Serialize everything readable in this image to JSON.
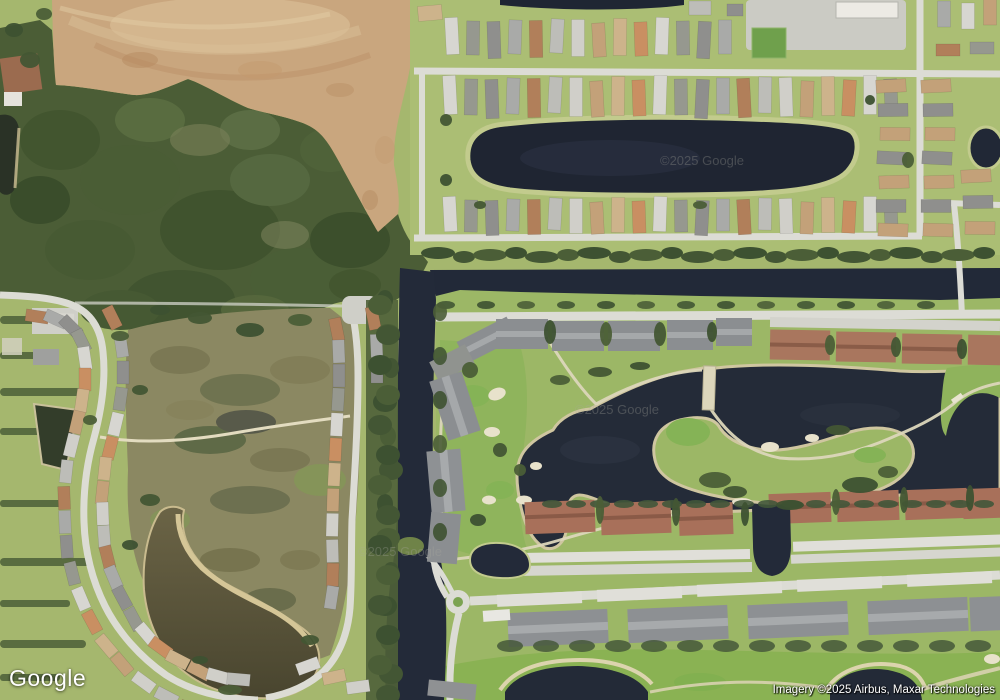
{
  "map": {
    "view_type": "satellite",
    "provider_logo": "Google",
    "attribution": "Imagery ©2025 Airbus, Maxar Technologies",
    "watermark": "©2025 Google"
  },
  "colors": {
    "grass": "#a5b76e",
    "grass_north": "#abbe74",
    "golf_base": "#9cb766",
    "fairway": "#8fb45c",
    "green_bright": "#85b356",
    "forest": "#4b5d36",
    "forest_dark": "#3d5131",
    "scrub": "#8b8862",
    "dirt": "#c9a67e",
    "dirt_light": "#dcc29a",
    "water_dark": "#222938",
    "water_pond_brown_top": "#6b6446",
    "water_pond_brown_bottom": "#49452f",
    "sand": "#d6c9a0",
    "road": "#dcdcd5",
    "condo_gray": "#8b8e91",
    "condo_red": "#a8705a",
    "carport_white": "#e0dfd9",
    "roofs": [
      "#a9aaa8",
      "#d7d6d1",
      "#c3a179",
      "#b17f5a",
      "#96988f",
      "#cdb38b",
      "#bdbdb8",
      "#8f8f8d",
      "#c98f62",
      "#d0cfc9"
    ]
  }
}
